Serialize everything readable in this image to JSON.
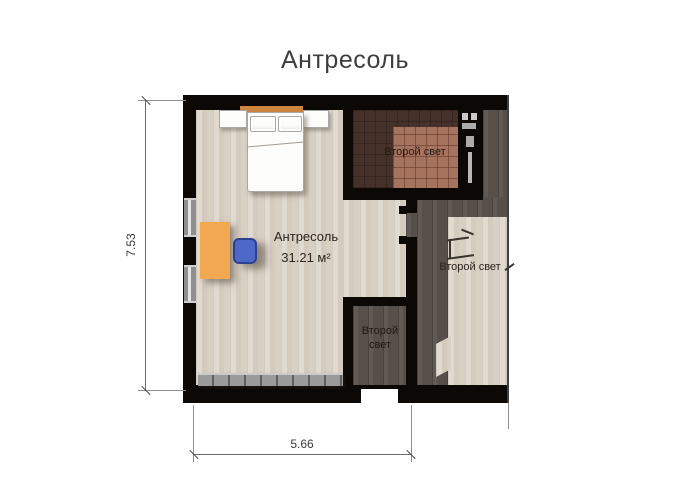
{
  "title": "Антресоль",
  "room": {
    "name": "Антресоль",
    "area": "31.21 м²"
  },
  "voids": {
    "top": "Второй свет",
    "right": "Второй свет",
    "small_line1": "Второй",
    "small_line2": "свет"
  },
  "dimensions": {
    "vertical": "7.53",
    "horizontal": "5.66"
  },
  "colors": {
    "wall": "#0b0806",
    "floor_light": "#d9d0c4",
    "floor_dark": "#57504a",
    "void_room_floor": "#46312a",
    "rug": "#a5735e",
    "desk": "#f2a851",
    "chair": "#4d68c6",
    "railing": "#9a9a9a",
    "dimension_line": "#6a6a6a"
  }
}
